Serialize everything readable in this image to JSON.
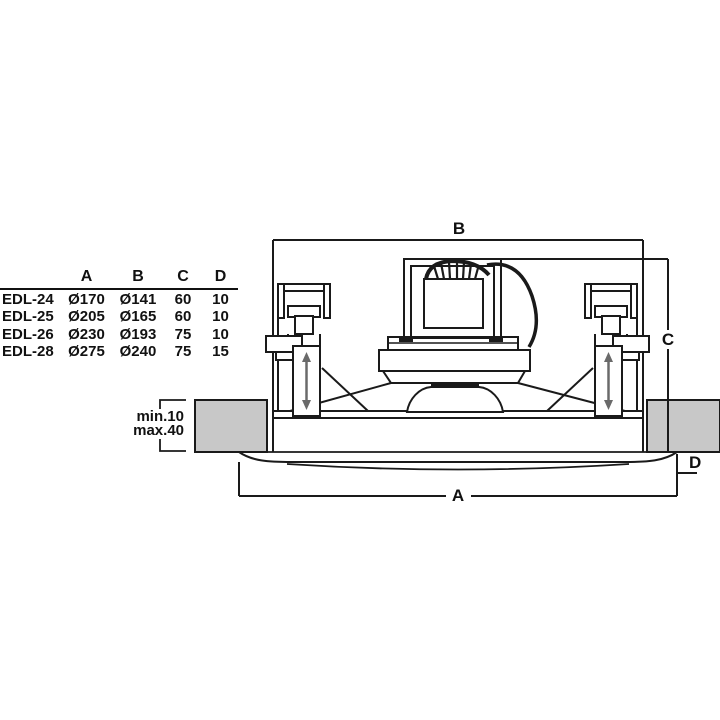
{
  "table": {
    "headers": [
      "A",
      "B",
      "C",
      "D"
    ],
    "rows": [
      {
        "model": "EDL-24",
        "A": "Ø170",
        "B": "Ø141",
        "C": "60",
        "D": "10"
      },
      {
        "model": "EDL-25",
        "A": "Ø205",
        "B": "Ø165",
        "C": "60",
        "D": "10"
      },
      {
        "model": "EDL-26",
        "A": "Ø230",
        "B": "Ø193",
        "C": "75",
        "D": "10"
      },
      {
        "model": "EDL-28",
        "A": "Ø275",
        "B": "Ø240",
        "C": "75",
        "D": "15"
      }
    ]
  },
  "diagram": {
    "dim_labels": {
      "a": "A",
      "b": "B",
      "c": "C",
      "d": "D"
    },
    "ceiling_note": {
      "line1": "min.10",
      "line2": "max.40"
    },
    "colors": {
      "line": "#1a1a1a",
      "ceiling_fill": "#c8c8c8",
      "arrow": "#6a6a6a",
      "background": "#ffffff"
    }
  }
}
